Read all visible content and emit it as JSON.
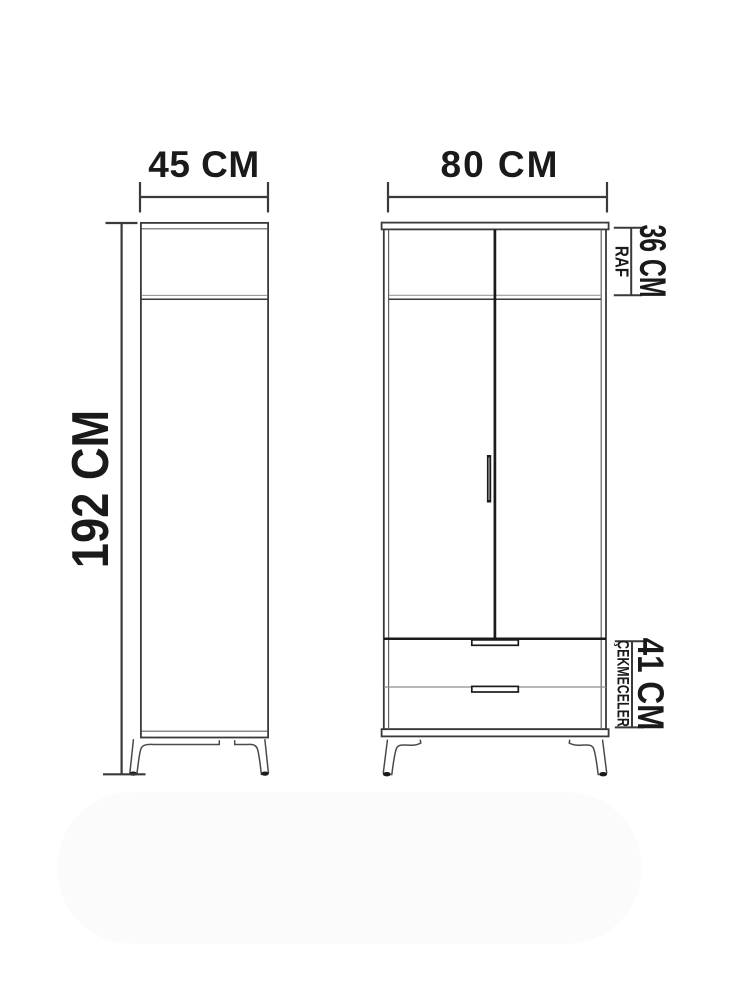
{
  "diagram": {
    "side_view": {
      "width_label": "45 CM",
      "height_label": "192 CM"
    },
    "front_view": {
      "width_label": "80 CM"
    },
    "callouts": {
      "shelf": {
        "label": "RAF",
        "size": "36 CM"
      },
      "drawers": {
        "label": "ÇEKMECELER",
        "size": "41 CM"
      }
    },
    "colors": {
      "line": "#3a3a3a",
      "line_dark": "#1a1a1a",
      "line_mid": "#606060",
      "line_light": "#9c9c9c",
      "text": "#1a1a1a",
      "background": "#ffffff"
    }
  }
}
